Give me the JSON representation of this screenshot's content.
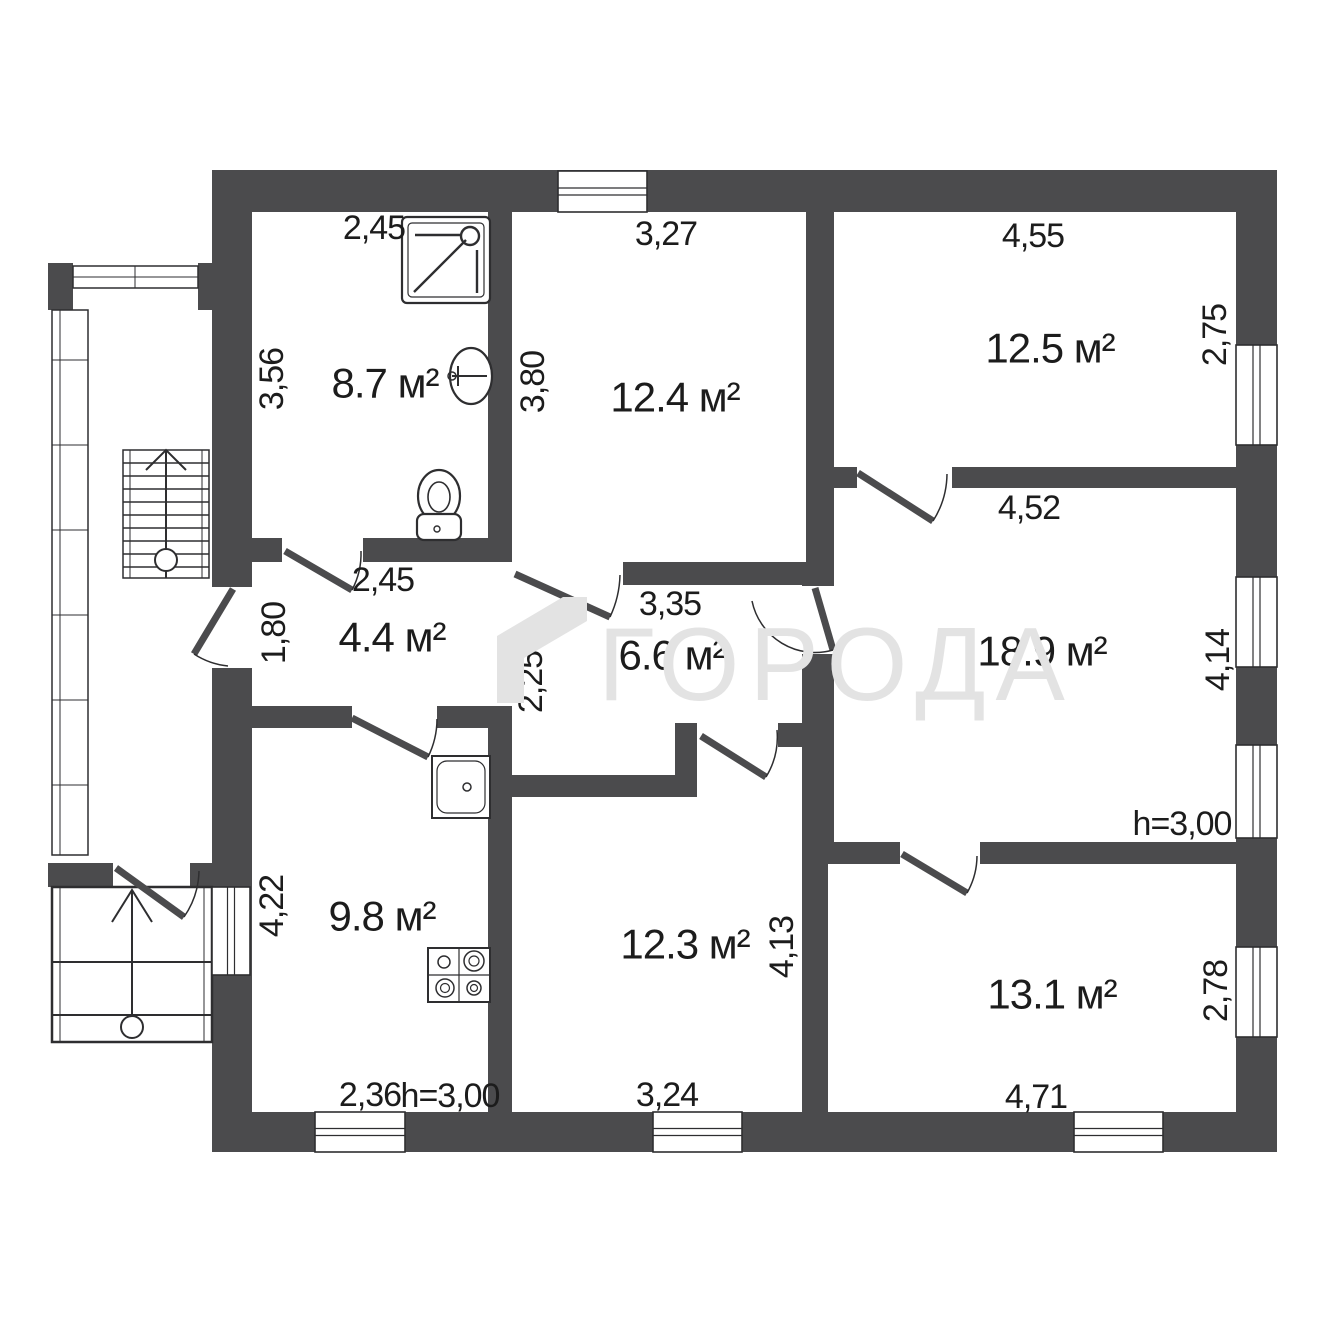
{
  "watermark": {
    "text": "ГОРОДА"
  },
  "colors": {
    "wall": "#4b4b4d",
    "line": "#2e2e30",
    "text": "#1c1c1c",
    "watermark": "#e3e3e3",
    "bg": "#ffffff"
  },
  "rooms": [
    {
      "label": "8.7 м²",
      "x": 385,
      "y": 383
    },
    {
      "label": "12.4 м²",
      "x": 675,
      "y": 397
    },
    {
      "label": "12.5 м²",
      "x": 1050,
      "y": 348
    },
    {
      "label": "4.4 м²",
      "x": 392,
      "y": 637
    },
    {
      "label": "6.6 м²",
      "x": 672,
      "y": 655
    },
    {
      "label": "18.9 м²",
      "x": 1042,
      "y": 651
    },
    {
      "label": "9.8 м²",
      "x": 382,
      "y": 916
    },
    {
      "label": "12.3 м²",
      "x": 685,
      "y": 944
    },
    {
      "label": "13.1 м²",
      "x": 1052,
      "y": 994
    }
  ],
  "dimensions": [
    {
      "label": "2,45",
      "x": 374,
      "y": 228,
      "rot": 0
    },
    {
      "label": "3,27",
      "x": 666,
      "y": 234,
      "rot": 0
    },
    {
      "label": "4,55",
      "x": 1033,
      "y": 236,
      "rot": 0
    },
    {
      "label": "3,56",
      "x": 272,
      "y": 379,
      "rot": -90
    },
    {
      "label": "3,80",
      "x": 533,
      "y": 382,
      "rot": -90
    },
    {
      "label": "2,75",
      "x": 1215,
      "y": 335,
      "rot": -90
    },
    {
      "label": "2,45",
      "x": 383,
      "y": 580,
      "rot": 0
    },
    {
      "label": "3,35",
      "x": 670,
      "y": 604,
      "rot": 0
    },
    {
      "label": "4,52",
      "x": 1029,
      "y": 508,
      "rot": 0
    },
    {
      "label": "1,80",
      "x": 274,
      "y": 633,
      "rot": -90
    },
    {
      "label": "2,25",
      "x": 531,
      "y": 682,
      "rot": -90
    },
    {
      "label": "4,14",
      "x": 1218,
      "y": 660,
      "rot": -90
    },
    {
      "label": "h=3,00",
      "x": 1182,
      "y": 824,
      "rot": 0
    },
    {
      "label": "4,22",
      "x": 272,
      "y": 906,
      "rot": -90
    },
    {
      "label": "4,13",
      "x": 782,
      "y": 947,
      "rot": -90
    },
    {
      "label": "2,78",
      "x": 1216,
      "y": 991,
      "rot": -90
    },
    {
      "label": "2,36",
      "x": 370,
      "y": 1095,
      "rot": 0
    },
    {
      "label": "h=3,00",
      "x": 450,
      "y": 1096,
      "rot": 0
    },
    {
      "label": "3,24",
      "x": 667,
      "y": 1095,
      "rot": 0
    },
    {
      "label": "4,71",
      "x": 1036,
      "y": 1097,
      "rot": 0
    }
  ],
  "geometry": {
    "walls": [
      [
        212,
        170,
        1065,
        42
      ],
      [
        212,
        170,
        40,
        942
      ],
      [
        1236,
        170,
        41,
        982
      ],
      [
        212,
        1112,
        1065,
        40
      ],
      [
        488,
        212,
        24,
        350
      ],
      [
        806,
        212,
        28,
        350
      ],
      [
        834,
        467,
        402,
        21
      ],
      [
        252,
        538,
        260,
        24
      ],
      [
        512,
        562,
        322,
        23
      ],
      [
        802,
        585,
        32,
        279
      ],
      [
        252,
        706,
        260,
        22
      ],
      [
        488,
        706,
        24,
        406
      ],
      [
        512,
        775,
        163,
        22
      ],
      [
        675,
        723,
        22,
        74
      ],
      [
        697,
        723,
        105,
        24
      ],
      [
        802,
        864,
        26,
        248
      ],
      [
        802,
        842,
        434,
        22
      ],
      [
        48,
        263,
        25,
        47
      ],
      [
        198,
        263,
        14,
        47
      ],
      [
        48,
        863,
        164,
        24
      ]
    ],
    "openings": [
      [
        282,
        538,
        81,
        24
      ],
      [
        212,
        587,
        40,
        81
      ],
      [
        352,
        706,
        85,
        22
      ],
      [
        512,
        562,
        111,
        23
      ],
      [
        802,
        586,
        32,
        68
      ],
      [
        857,
        467,
        95,
        21
      ],
      [
        697,
        723,
        81,
        24
      ],
      [
        900,
        842,
        80,
        22
      ],
      [
        113,
        863,
        77,
        24
      ]
    ],
    "windows": [
      {
        "x": 558,
        "y": 171,
        "w": 89,
        "h": 41,
        "o": "h"
      },
      {
        "x": 1236,
        "y": 345,
        "w": 41,
        "h": 100,
        "o": "v"
      },
      {
        "x": 1236,
        "y": 577,
        "w": 41,
        "h": 90,
        "o": "v"
      },
      {
        "x": 1236,
        "y": 745,
        "w": 41,
        "h": 93,
        "o": "v"
      },
      {
        "x": 1236,
        "y": 947,
        "w": 41,
        "h": 90,
        "o": "v"
      },
      {
        "x": 315,
        "y": 1112,
        "w": 90,
        "h": 40,
        "o": "h"
      },
      {
        "x": 653,
        "y": 1112,
        "w": 89,
        "h": 40,
        "o": "h"
      },
      {
        "x": 1074,
        "y": 1112,
        "w": 89,
        "h": 40,
        "o": "h"
      },
      {
        "x": 212,
        "y": 887,
        "w": 38,
        "h": 88,
        "o": "v"
      }
    ],
    "doors": [
      {
        "h": [
          285,
          551
        ],
        "l": [
          352,
          590
        ],
        "r": [
          361,
          551
        ],
        "s": 0
      },
      {
        "h": [
          233,
          589
        ],
        "l": [
          194,
          654
        ],
        "r": [
          228,
          666
        ],
        "s": 0
      },
      {
        "h": [
          352,
          718
        ],
        "l": [
          428,
          757
        ],
        "r": [
          437,
          719
        ],
        "s": 0
      },
      {
        "h": [
          515,
          574
        ],
        "l": [
          610,
          617
        ],
        "r": [
          620,
          575
        ],
        "s": 0
      },
      {
        "h": [
          815,
          588
        ],
        "l": [
          833,
          650
        ],
        "r": [
          752,
          601
        ],
        "s": 1
      },
      {
        "h": [
          858,
          473
        ],
        "l": [
          933,
          521
        ],
        "r": [
          947,
          474
        ],
        "s": 0
      },
      {
        "h": [
          701,
          736
        ],
        "l": [
          766,
          777
        ],
        "r": [
          777,
          730
        ],
        "s": 0
      },
      {
        "h": [
          902,
          854
        ],
        "l": [
          967,
          893
        ],
        "r": [
          977,
          856
        ],
        "s": 0
      },
      {
        "h": [
          116,
          868
        ],
        "l": [
          184,
          917
        ],
        "r": [
          199,
          871
        ],
        "s": 0
      }
    ],
    "glazing": {
      "left": {
        "x": 52,
        "y": 310,
        "w": 36,
        "h": 545,
        "ticks": [
          360,
          445,
          530,
          615,
          700,
          785
        ]
      },
      "top": {
        "x": 73,
        "y": 266,
        "w": 125,
        "h": 22,
        "tick": 135
      }
    },
    "stairs": {
      "x": 123,
      "y": 450,
      "w": 86,
      "h": 128,
      "treads": 9,
      "cx": 166,
      "circle": [
        166,
        560,
        11
      ],
      "arrow": [
        [
          146,
          470
        ],
        [
          166,
          450
        ],
        [
          186,
          470
        ]
      ]
    },
    "porch": {
      "x": 52,
      "y": 887,
      "w": 160,
      "h": 155,
      "steps": [
        962,
        1015
      ],
      "cx": 132,
      "circle": [
        132,
        1027,
        11
      ],
      "arrow": [
        [
          112,
          922
        ],
        [
          132,
          890
        ],
        [
          152,
          922
        ]
      ]
    }
  },
  "fixtures": [
    {
      "name": "shower-icon",
      "x": 402,
      "y": 217,
      "w": 88,
      "h": 86
    },
    {
      "name": "washbasin-icon",
      "cx": 471,
      "cy": 376,
      "rx": 21,
      "ry": 28
    },
    {
      "name": "toilet-icon",
      "cx": 439,
      "cy": 496
    },
    {
      "name": "kitchen-sink-icon",
      "x": 432,
      "y": 756,
      "w": 58,
      "h": 62
    },
    {
      "name": "stove-icon",
      "x": 428,
      "y": 948,
      "w": 62,
      "h": 54
    }
  ]
}
